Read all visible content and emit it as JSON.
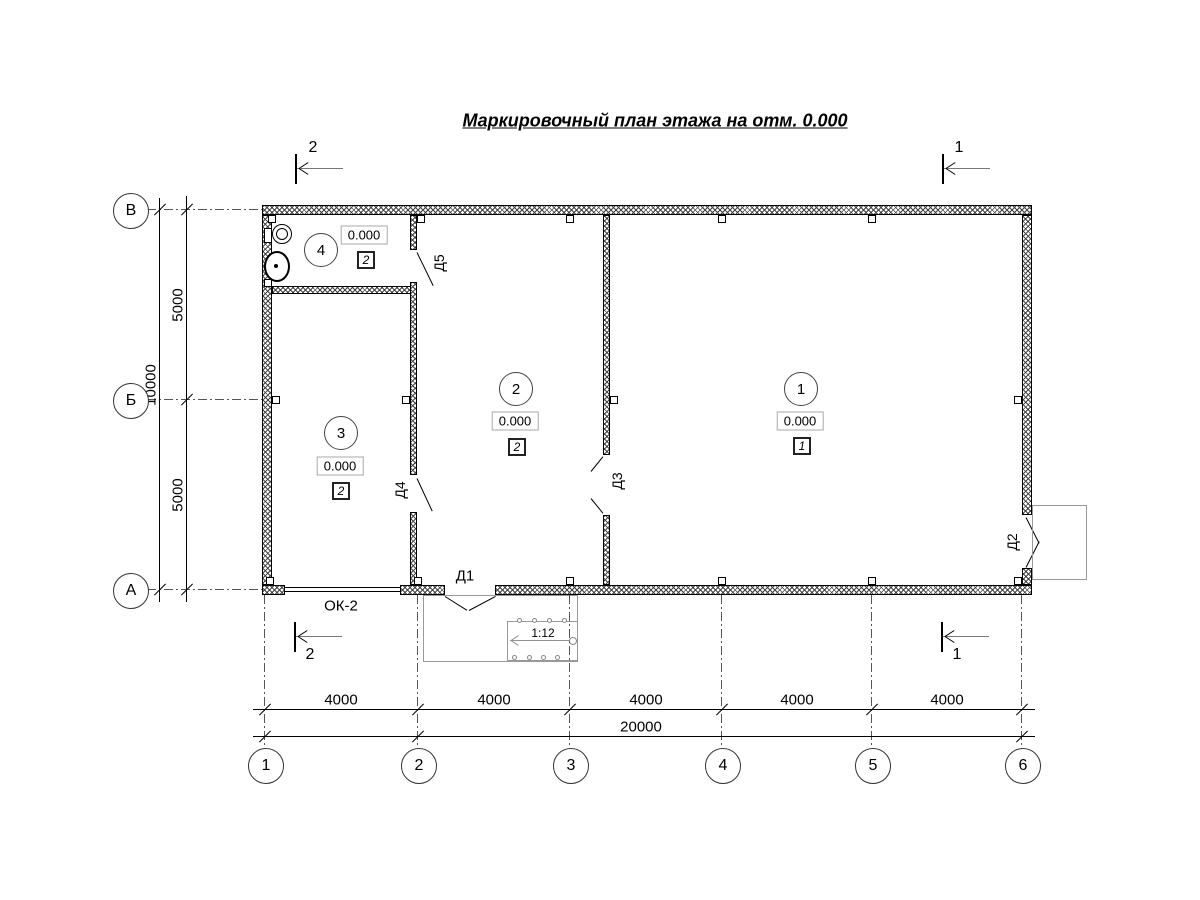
{
  "title": "Маркировочный план этажа на отм. 0.000",
  "plan": {
    "rooms": [
      {
        "number": "1",
        "elevation": "0.000",
        "floor_type": "1"
      },
      {
        "number": "2",
        "elevation": "0.000",
        "floor_type": "2"
      },
      {
        "number": "3",
        "elevation": "0.000",
        "floor_type": "2"
      },
      {
        "number": "4",
        "elevation": "0.000",
        "floor_type": "2"
      }
    ],
    "doors": {
      "d1": "Д1",
      "d2": "Д2",
      "d3": "Д3",
      "d4": "Д4",
      "d5": "Д5"
    },
    "window_label": "ОК-2",
    "ramp_slope": "1:12"
  },
  "axes": {
    "rows": [
      {
        "label": "В"
      },
      {
        "label": "Б"
      },
      {
        "label": "А"
      }
    ],
    "cols": [
      {
        "label": "1"
      },
      {
        "label": "2"
      },
      {
        "label": "3"
      },
      {
        "label": "4"
      },
      {
        "label": "5"
      },
      {
        "label": "6"
      }
    ]
  },
  "dimensions": {
    "left_segments": [
      "5000",
      "5000"
    ],
    "left_total": "10000",
    "bottom_segments": [
      "4000",
      "4000",
      "4000",
      "4000",
      "4000"
    ],
    "bottom_total": "20000"
  },
  "sections": {
    "one": "1",
    "two": "2"
  },
  "colors": {
    "ink": "#000000",
    "secondary": "#909090"
  }
}
